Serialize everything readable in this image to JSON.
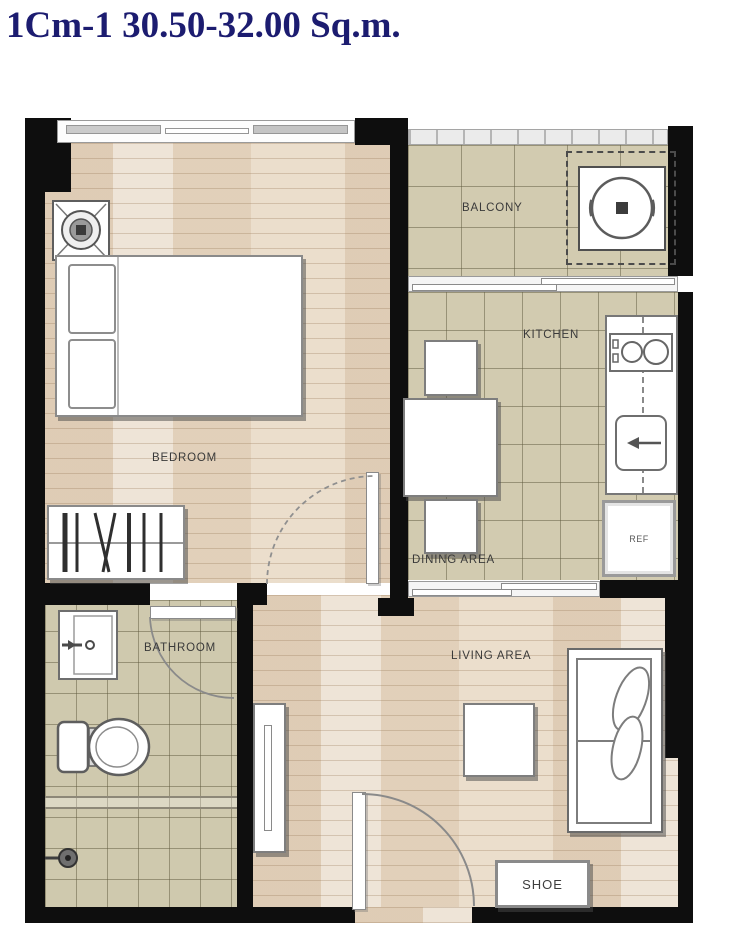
{
  "title": "1Cm-1 30.50-32.00 Sq.m.",
  "rooms": {
    "bedroom": {
      "label": "BEDROOM"
    },
    "balcony": {
      "label": "BALCONY"
    },
    "kitchen": {
      "label": "KITCHEN"
    },
    "dining": {
      "label": "DINING AREA"
    },
    "bathroom": {
      "label": "BATHROOM"
    },
    "living": {
      "label": "LIVING AREA"
    }
  },
  "furniture": {
    "refrigerator": {
      "label": "REF"
    },
    "shoe_cabinet": {
      "label": "SHOE"
    }
  },
  "colors": {
    "title_text": "#1c1c70",
    "walls": "#0e0e0e",
    "wood_floor": "#e7d9c6",
    "tile_floor": "#d2cbb0"
  }
}
